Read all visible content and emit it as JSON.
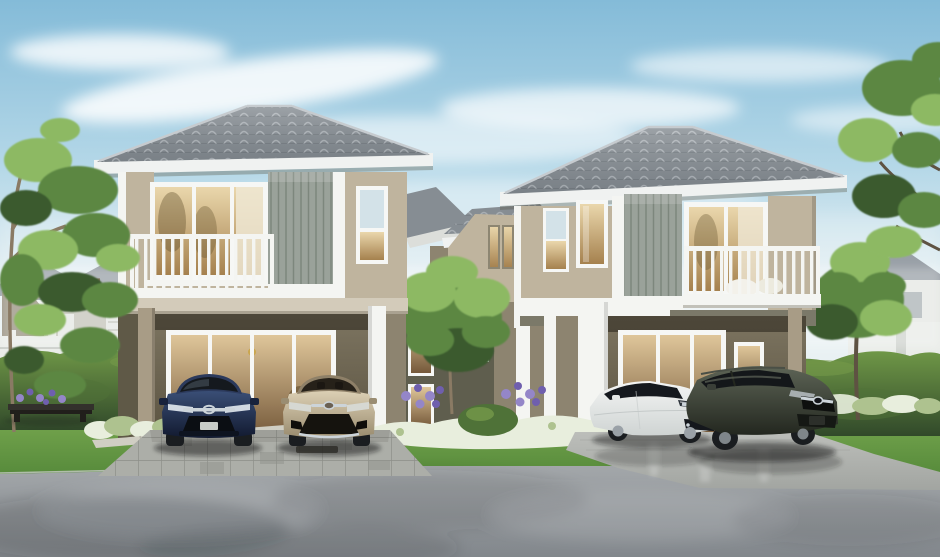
{
  "scene": {
    "type": "3d-architectural-rendering",
    "description": "Two modern two-storey detached houses with grey tiled hip roofs, white-railed balconies and ground-floor carports; four parked cars; landscaped garden with hedges, trees, lavender and white flower beds, paver driveways and an asphalt road under a hazy blue sky.",
    "houses": [
      {
        "id": "house-left",
        "storeys": 2,
        "features": [
          "hip tiled roof",
          "picture window with white frame",
          "white balcony railing",
          "grey-green vertical siding",
          "taupe render walls",
          "narrow stair window",
          "double carport",
          "glazed sliding doors"
        ],
        "vehicles": [
          "dark-blue-sedan",
          "champagne-sedan"
        ]
      },
      {
        "id": "house-right",
        "storeys": 2,
        "features": [
          "hip tiled roof",
          "picture window with white frame",
          "white balcony railing with cushions behind",
          "grey-green vertical siding",
          "taupe render walls",
          "rear wing with slot windows",
          "double carport",
          "glazed french doors"
        ],
        "vehicles": [
          "white-coupe",
          "dark-grey-suv"
        ]
      }
    ],
    "vehicles": [
      {
        "id": "dark-blue-sedan",
        "type": "sedan",
        "color": "#1f2c50"
      },
      {
        "id": "champagne-sedan",
        "type": "sedan",
        "color": "#b5a88b"
      },
      {
        "id": "white-coupe",
        "type": "coupe",
        "color": "#edefee"
      },
      {
        "id": "dark-grey-suv",
        "type": "suv",
        "color": "#2e332e"
      }
    ],
    "environment": {
      "sky": "pale blue with soft wispy clouds",
      "vegetation": [
        "tall tree at left edge",
        "tree between the houses",
        "tree right of houses",
        "tree in top right corner",
        "long clipped hedges",
        "low box hedge",
        "hedge ball",
        "lavender clusters",
        "white flower border",
        "green lawn"
      ],
      "hardscape": [
        "square paver driveway",
        "wet concrete driveway",
        "asphalt road",
        "stone garden path",
        "dark garden bench",
        "door mat"
      ],
      "background": [
        "neighbouring houses with grey roofs",
        "white boundary fence"
      ]
    }
  },
  "palette": {
    "sky_top": "#84bbd8",
    "sky_mid": "#b5d8e8",
    "sky_horizon": "#e9f1f3",
    "cloud": "#ffffff",
    "roof_base": "#868d93",
    "roof_tile_light": "#b6bcc1",
    "roof_ridge": "#c6cbcf",
    "fascia": "#f0f2f1",
    "trim": "#f4f5f2",
    "frame": "#f6f7f5",
    "taupe_light": "#bfb49e",
    "taupe": "#a89c86",
    "taupe_dark": "#8d8470",
    "siding": "#9aa29a",
    "siding_groove": "#7d877d",
    "band": "#d3cbba",
    "band_olive": "#7b7969",
    "carport_top": "#7d7561",
    "carport_bottom": "#59513f",
    "annex": "#5f5e4e",
    "glass_sky": "#d3e2e8",
    "glass_warm_top": "#ead7ac",
    "glass_warm_bot": "#a5814e",
    "door_glass_top": "#dfc69a",
    "door_glass_bot": "#75593a",
    "curtain": "#efe7d4",
    "neighbor_roof": "#99a0a7",
    "neighbor_wall": "#c3c4b8",
    "neighbor_wall_dark": "#97907f",
    "neighbor_white": "#e5e7e3",
    "fence": "#e9ece8",
    "hedge_top": "#6f9747",
    "hedge_bottom": "#31492a",
    "hedge_mid": "#4f7238",
    "hedge_light": "#74994a",
    "lawn_top": "#7fae54",
    "lawn_bottom": "#55893a",
    "tree_dark": "#3a5a2e",
    "tree_mid": "#5c8742",
    "tree_light": "#8db964",
    "trunk": "#8a7a64",
    "branch": "#5e5242",
    "lavender": "#9486c8",
    "lavender_dark": "#6f5fae",
    "flower_white": "#e8eedd",
    "shrub_green": "#aec28f",
    "paver": "#acaea8",
    "paver_line": "#8d8f89",
    "paver_dark": "#8f918b",
    "wet_top": "#bcbeba",
    "wet_bottom": "#a2a5a1",
    "road_top": "#a3a7aa",
    "road_bottom": "#82878c",
    "path_stone": "#d0cec3",
    "bench": "#33312c",
    "mat": "#3b382f",
    "car_navy_top": "#3b5078",
    "car_navy_bot": "#121a30",
    "car_navy_roof": "#2c3a5c",
    "car_beige_top": "#ddd1b6",
    "car_beige_bot": "#998b6e",
    "car_white_top": "#f4f5f4",
    "car_white_bot": "#cfd4d3",
    "car_suv_top": "#5d6456",
    "car_suv_bot": "#23271f",
    "chrome": "#ccd4d9",
    "glass_black": "#15191e",
    "tire": "#1a1d20"
  }
}
